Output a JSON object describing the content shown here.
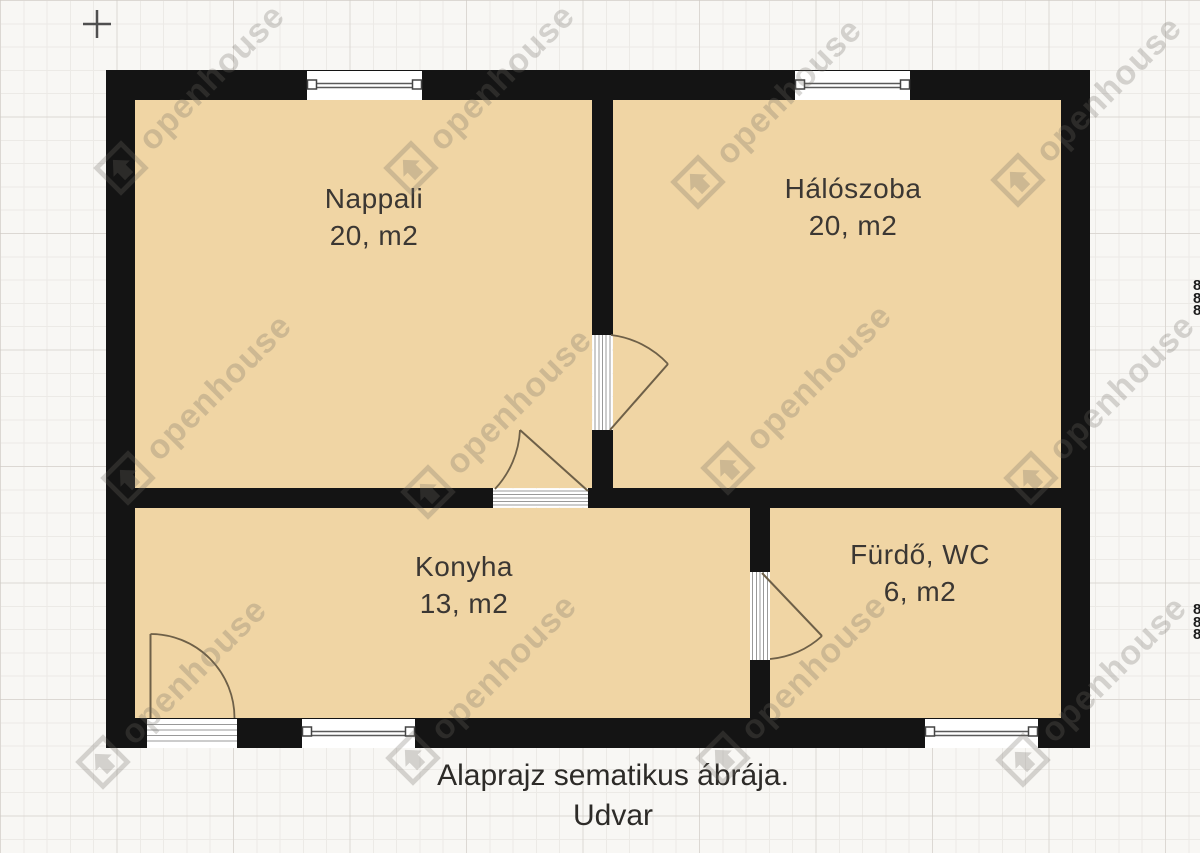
{
  "diagram": {
    "type": "floor-plan",
    "rooms": [
      {
        "id": "nappali",
        "name": "Nappali",
        "area": "20, m2"
      },
      {
        "id": "haloszoba",
        "name": "Hálószoba",
        "area": "20, m2"
      },
      {
        "id": "konyha",
        "name": "Konyha",
        "area": "13, m2"
      },
      {
        "id": "furdo",
        "name": "Fürdő, WC",
        "area": "6, m2"
      }
    ],
    "caption_line1": "Alaprajz sematikus ábrája.",
    "caption_line2": "Udvar",
    "edge_fragment": "8\n8\n8"
  },
  "watermark": {
    "text": "openhouse"
  },
  "colors": {
    "wall": "#141414",
    "room_fill": "#f0d5a4",
    "door_swing": "#6e6048",
    "background": "#f8f7f4"
  }
}
